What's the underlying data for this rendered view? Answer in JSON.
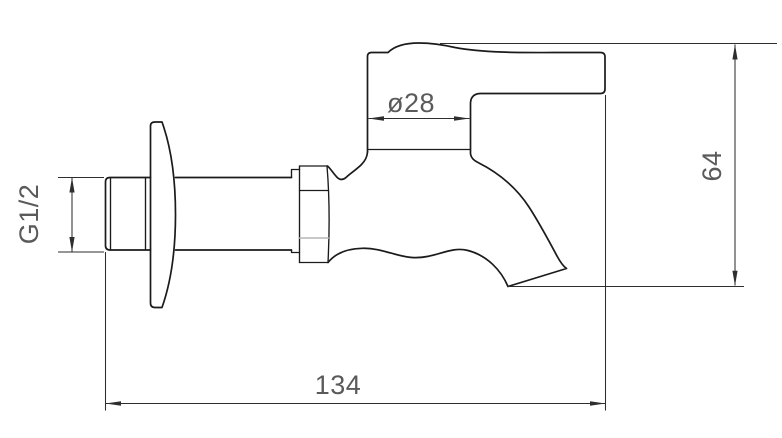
{
  "drawing": {
    "kind": "technical-dimension-drawing",
    "subject": "wall-mounted-bib-tap-side-view",
    "dimensions": {
      "body_diameter": {
        "label": "ø28",
        "value": 28,
        "symbol": "diameter"
      },
      "overall_height": {
        "label": "64",
        "value": 64
      },
      "inlet_thread": {
        "label": "G1/2"
      },
      "overall_length": {
        "label": "134",
        "value": 134
      }
    }
  },
  "colors": {
    "background": "#ffffff",
    "outline": "#1b1b1b",
    "dim-line": "#2e2e2e",
    "dim-text": "#5a5a5a",
    "facet-gray": "#b5b5b5"
  }
}
